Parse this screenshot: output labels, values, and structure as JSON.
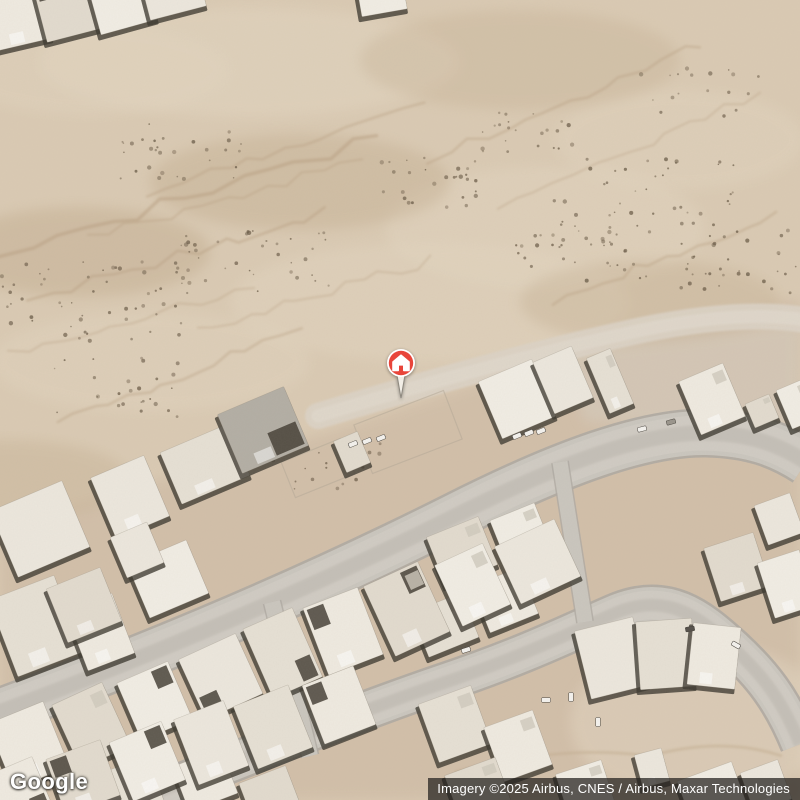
{
  "map": {
    "provider": "Google",
    "view": "satellite",
    "marker": {
      "name": "property-location",
      "icon": "home",
      "pin_color": "#E8453A",
      "ring_color": "#FFFFFF",
      "x": 401,
      "y": 363
    },
    "colors": {
      "desert_base": "#DACAB3",
      "desert_lower": "#D2BFA9",
      "streak": "#B89F81",
      "shrub": "#6F604C",
      "road_fill": "#CAC6BE",
      "road_edge": "#AFAAA2",
      "road_wear": "#BCB7AF",
      "dirt_road": "#DCD3C6",
      "dirt_core": "#E1D9CD",
      "building_palette": [
        "#F1EDE4",
        "#ECE7DD",
        "#E6E0D4",
        "#EFEAE0",
        "#E2DBCE"
      ],
      "building_shadow": "#3C3830",
      "courtyard": "#453F36",
      "car_default": "#F4F2EE",
      "patch_light": "#E3D6C1",
      "patch_dark": "#C3AD90"
    },
    "developed_area": "0,525 330,432 520,370 660,330 800,298 800,800 0,800",
    "patches": [
      [
        250,
        62,
        210,
        55,
        0.5
      ],
      [
        545,
        228,
        160,
        62,
        0.45
      ],
      [
        680,
        140,
        125,
        50,
        0.4
      ],
      [
        150,
        362,
        160,
        50,
        0.4
      ],
      [
        430,
        302,
        200,
        60,
        0.45
      ],
      [
        700,
        722,
        130,
        80,
        0.5
      ],
      [
        90,
        70,
        140,
        45,
        0.4
      ],
      [
        80,
        252,
        130,
        45,
        0.45,
        "d"
      ],
      [
        300,
        182,
        150,
        48,
        0.4,
        "d"
      ],
      [
        650,
        302,
        130,
        42,
        0.35,
        "d"
      ],
      [
        520,
        60,
        160,
        50,
        0.3,
        "d"
      ],
      [
        10,
        480,
        120,
        40,
        0.35,
        "d"
      ]
    ],
    "smooth_zones": [
      {
        "pts": "560,352 800,322 800,430 585,422",
        "c": "#D6CDBF",
        "op": 0.55
      }
    ],
    "streaks": [
      [
        0,
        258,
        380,
        136,
        7,
        3.5,
        0.5,
        101
      ],
      [
        30,
        300,
        330,
        212,
        6,
        2.5,
        0.45,
        102
      ],
      [
        150,
        195,
        420,
        100,
        6,
        2.5,
        0.4,
        103
      ],
      [
        60,
        420,
        300,
        330,
        5,
        2.5,
        0.4,
        104
      ],
      [
        430,
        160,
        700,
        42,
        6,
        2.5,
        0.4,
        105
      ],
      [
        500,
        205,
        762,
        92,
        5,
        2,
        0.35,
        106
      ],
      [
        555,
        300,
        780,
        215,
        5,
        2.5,
        0.4,
        107
      ],
      [
        10,
        355,
        250,
        285,
        5,
        2,
        0.35,
        108
      ],
      [
        90,
        238,
        360,
        160,
        5,
        2,
        0.4,
        109
      ],
      [
        200,
        330,
        430,
        260,
        5,
        2,
        0.35,
        110
      ]
    ],
    "shrub_clusters": [
      [
        95,
        302,
        95,
        40,
        55,
        201
      ],
      [
        255,
        262,
        80,
        32,
        40,
        202
      ],
      [
        425,
        182,
        60,
        26,
        28,
        203
      ],
      [
        645,
        202,
        95,
        45,
        50,
        204
      ],
      [
        742,
        262,
        62,
        32,
        32,
        205
      ],
      [
        185,
        152,
        70,
        28,
        30,
        206
      ],
      [
        525,
        132,
        52,
        20,
        22,
        207
      ],
      [
        700,
        92,
        60,
        25,
        18,
        208
      ],
      [
        320,
        462,
        65,
        28,
        22,
        209
      ],
      [
        120,
        388,
        70,
        30,
        26,
        210
      ],
      [
        585,
        252,
        70,
        30,
        30,
        211
      ]
    ],
    "dirt_tracks": [
      {
        "d": "M 318,416 C 430,382 540,352 642,330 C 706,317 762,313 805,320",
        "w": 26,
        "op": 0.9
      },
      {
        "d": "M 318,416 C 430,382 540,352 642,330 C 706,317 762,313 805,320",
        "w": 13,
        "op": 0.75,
        "core": true
      }
    ],
    "roads": [
      {
        "id": "main-road",
        "d": "M -6,714 C 140,660 300,594 455,516 C 560,463 645,432 706,433 C 750,434 778,444 806,462",
        "w": 44
      },
      {
        "id": "lower-road",
        "d": "M 112,810 C 230,764 335,720 440,684 C 530,654 580,628 618,612 C 668,592 700,618 731,646 C 762,674 782,700 800,744",
        "w": 36
      }
    ],
    "streets": [
      {
        "d": "M 272,602 L 310,756",
        "w": 16
      },
      {
        "d": "M 560,462 L 585,622",
        "w": 15
      }
    ],
    "arcs": [
      {
        "d": "M 455,772 Q 560,744 650,756 Q 722,736 782,756",
        "w": 3,
        "op": 0.5
      }
    ],
    "fences": [
      [
        408,
        432,
        96,
        52,
        -21
      ],
      [
        318,
        468,
        64,
        38,
        -22
      ]
    ],
    "building_blocks": [
      {
        "id": "top-left-row",
        "x1": 20,
        "y1": 16,
        "x2": 172,
        "y2": -14,
        "n": 4,
        "w": [
          52,
          62
        ],
        "h": [
          60,
          72
        ],
        "a": -14,
        "seed": 11
      },
      {
        "id": "mid-row",
        "x1": 30,
        "y1": 746,
        "x2": 535,
        "y2": 562,
        "n": 9,
        "w": [
          52,
          66
        ],
        "h": [
          62,
          78
        ],
        "a": -23,
        "seed": 23
      },
      {
        "id": "bottom-row",
        "x1": 20,
        "y1": 793,
        "x2": 340,
        "y2": 708,
        "n": 6,
        "w": [
          52,
          62
        ],
        "h": [
          58,
          70
        ],
        "a": -21,
        "seed": 37
      }
    ],
    "buildings": [
      [
        382,
        -2,
        46,
        30,
        -10
      ],
      [
        130,
        497,
        58,
        66,
        -23
      ],
      [
        205,
        464,
        74,
        56,
        -23
      ],
      [
        263,
        430,
        72,
        64,
        -23,
        1
      ],
      [
        352,
        452,
        26,
        34,
        -23
      ],
      [
        517,
        399,
        58,
        62,
        -23
      ],
      [
        563,
        380,
        42,
        56,
        -23
      ],
      [
        610,
        381,
        26,
        60,
        -23
      ],
      [
        712,
        399,
        48,
        58,
        -23
      ],
      [
        762,
        411,
        26,
        26,
        -23
      ],
      [
        798,
        404,
        30,
        42,
        -23
      ],
      [
        40,
        529,
        78,
        72,
        -23
      ],
      [
        36,
        626,
        70,
        82,
        -21
      ],
      [
        100,
        632,
        50,
        64,
        -21
      ],
      [
        84,
        605,
        58,
        58,
        -22
      ],
      [
        168,
        579,
        64,
        58,
        -23
      ],
      [
        137,
        550,
        40,
        44,
        -23
      ],
      [
        445,
        625,
        54,
        48,
        -22
      ],
      [
        505,
        600,
        52,
        50,
        -22
      ],
      [
        462,
        551,
        56,
        52,
        -22
      ],
      [
        521,
        534,
        48,
        48,
        -22
      ],
      [
        612,
        658,
        60,
        70,
        -14
      ],
      [
        666,
        654,
        56,
        68,
        -4
      ],
      [
        714,
        656,
        48,
        62,
        6
      ],
      [
        737,
        567,
        52,
        56,
        -18
      ],
      [
        787,
        584,
        44,
        58,
        -18
      ],
      [
        779,
        519,
        38,
        42,
        -20
      ],
      [
        455,
        724,
        56,
        62,
        -20
      ],
      [
        518,
        746,
        52,
        58,
        -20
      ],
      [
        478,
        789,
        54,
        48,
        -20
      ],
      [
        585,
        788,
        48,
        44,
        -18
      ],
      [
        652,
        768,
        28,
        34,
        -15
      ],
      [
        130,
        790,
        56,
        52,
        -21
      ],
      [
        205,
        780,
        52,
        48,
        -21
      ],
      [
        270,
        795,
        50,
        44,
        -21
      ],
      [
        712,
        793,
        58,
        46,
        -20
      ],
      [
        766,
        786,
        40,
        42,
        -20
      ]
    ],
    "cars": [
      [
        353,
        444,
        -22
      ],
      [
        367,
        441,
        -22
      ],
      [
        381,
        438,
        -22
      ],
      [
        517,
        436,
        -22
      ],
      [
        529,
        433,
        -22
      ],
      [
        541,
        431,
        -22
      ],
      [
        642,
        429,
        -15
      ],
      [
        671,
        422,
        -15,
        "#9A958C"
      ],
      [
        466,
        650,
        -18
      ],
      [
        546,
        700,
        0
      ],
      [
        571,
        697,
        90
      ],
      [
        598,
        722,
        90
      ],
      [
        690,
        629,
        -10,
        "#55504A"
      ],
      [
        736,
        645,
        30
      ]
    ]
  },
  "overlays": {
    "logo": {
      "text": "Google"
    },
    "attribution": {
      "text": "Imagery ©2025 Airbus, CNES / Airbus, Maxar Technologies"
    }
  }
}
